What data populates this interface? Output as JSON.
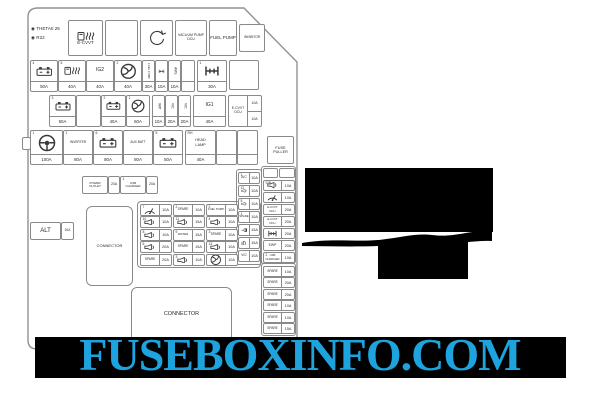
{
  "watermark": {
    "text": "FUSEBOXINFO.COM",
    "color": "#1da4de",
    "band_color": "#000000"
  },
  "corner": {
    "line1": "◉ THETAII 25",
    "line2": "◉ R22"
  },
  "colors": {
    "line": "#8a8a8a",
    "text": "#2b2b2b",
    "redaction": "#000000"
  },
  "boxes": [
    {
      "name": "grid-group",
      "kind": "group",
      "x": 137,
      "y": 201,
      "w": 124,
      "h": 67,
      "r": 4
    },
    {
      "name": "col4-group",
      "kind": "group",
      "x": 236,
      "y": 169,
      "w": 26,
      "h": 96,
      "r": 3
    },
    {
      "name": "strip-group-upper",
      "kind": "group",
      "x": 261,
      "y": 166,
      "w": 35,
      "h": 98,
      "r": 3
    },
    {
      "name": "strip-group-spare",
      "kind": "group",
      "x": 261,
      "y": 263,
      "w": 35,
      "h": 73,
      "r": 3
    },
    {
      "name": "mount-tab",
      "kind": "plain",
      "x": 22,
      "y": 137,
      "w": 9,
      "h": 13
    },
    {
      "name": "module-e-cvvt",
      "kind": "module",
      "x": 68,
      "y": 20,
      "w": 35,
      "h": 36,
      "label": "E-CVVT",
      "icon": "fuel-glow",
      "fs": 4.5
    },
    {
      "name": "module-blank",
      "kind": "module",
      "x": 105,
      "y": 20,
      "w": 33,
      "h": 36
    },
    {
      "name": "module-belt",
      "kind": "module",
      "x": 140,
      "y": 20,
      "w": 33,
      "h": 36,
      "icon": "circle-arrow"
    },
    {
      "name": "module-vacuum-pump-dcu",
      "kind": "module",
      "x": 175,
      "y": 20,
      "w": 32,
      "h": 36,
      "label": "VACUUM PUMP",
      "label2": "DCU",
      "fs": 3.5
    },
    {
      "name": "module-fuel-pump",
      "kind": "module",
      "x": 209,
      "y": 20,
      "w": 28,
      "h": 36,
      "label": "FUEL PUMP",
      "fs": 4.5
    },
    {
      "name": "module-inhibitor",
      "kind": "module",
      "x": 239,
      "y": 24,
      "w": 26,
      "h": 28,
      "label": "INHIBITOR",
      "fs": 3.2
    },
    {
      "name": "fuse-battery-50a",
      "kind": "vfuse",
      "x": 30,
      "y": 60,
      "w": 28,
      "h": 32,
      "icon": "battery",
      "amp": "50A",
      "num": "4"
    },
    {
      "name": "fuse-fuel-heater-40a",
      "kind": "vfuse",
      "x": 58,
      "y": 60,
      "w": 28,
      "h": 32,
      "icon": "fuel-glow",
      "amp": "40A",
      "num": "6"
    },
    {
      "name": "fuse-ig2-40a",
      "kind": "vfuse",
      "x": 86,
      "y": 60,
      "w": 28,
      "h": 32,
      "label": "IG2",
      "amp": "40A",
      "fs": 5
    },
    {
      "name": "fuse-fan-40a",
      "kind": "vfuse",
      "x": 114,
      "y": 60,
      "w": 28,
      "h": 32,
      "icon": "fan",
      "amp": "40A",
      "num": "2"
    },
    {
      "name": "fuse-fuel-pump-30a",
      "kind": "vfuse",
      "x": 142,
      "y": 60,
      "w": 13,
      "h": 32,
      "label": "FUEL PUMP",
      "vert": 1,
      "amp": "30A",
      "fs": 2.8
    },
    {
      "name": "fuse-hub-10a",
      "kind": "vfuse",
      "x": 155,
      "y": 60,
      "w": 13,
      "h": 32,
      "icon": "hub",
      "amp": "10A"
    },
    {
      "name": "fuse-ams-10a",
      "kind": "vfuse",
      "x": 168,
      "y": 60,
      "w": 13,
      "h": 32,
      "label": "AMS",
      "vert": 1,
      "amp": "10A",
      "fs": 3.4
    },
    {
      "name": "fuse-blank-narrow",
      "kind": "vfuse",
      "x": 181,
      "y": 60,
      "w": 14,
      "h": 32,
      "label": "",
      "amp": ""
    },
    {
      "name": "fuse-4wd-30a",
      "kind": "vfuse",
      "x": 197,
      "y": 60,
      "w": 30,
      "h": 32,
      "icon": "hub",
      "amp": "30A",
      "num": "1"
    },
    {
      "name": "box-blank-row1",
      "kind": "plain",
      "x": 229,
      "y": 60,
      "w": 30,
      "h": 30
    },
    {
      "name": "fuse-battery-60a",
      "kind": "vfuse",
      "x": 49,
      "y": 95,
      "w": 27,
      "h": 32,
      "icon": "battery",
      "amp": "60A",
      "num": "3"
    },
    {
      "name": "box-blank-row2",
      "kind": "plain",
      "x": 76,
      "y": 95,
      "w": 25,
      "h": 32
    },
    {
      "name": "fuse-battery-40a",
      "kind": "vfuse",
      "x": 101,
      "y": 95,
      "w": 25,
      "h": 32,
      "icon": "battery",
      "amp": "40A",
      "num": "2"
    },
    {
      "name": "fuse-fan-60a",
      "kind": "vfuse",
      "x": 126,
      "y": 95,
      "w": 24,
      "h": 32,
      "icon": "fan",
      "amp": "60A",
      "num": "1"
    },
    {
      "name": "fuse-wp-10a",
      "kind": "vfuse",
      "x": 152,
      "y": 95,
      "w": 13,
      "h": 32,
      "label": "W/P",
      "vert": 1,
      "amp": "10A",
      "fs": 3.4
    },
    {
      "name": "fuse-vc-20a-1",
      "kind": "vfuse",
      "x": 165,
      "y": 95,
      "w": 13,
      "h": 32,
      "label": "V/C",
      "vert": 1,
      "amp": "20A",
      "fs": 3.4
    },
    {
      "name": "fuse-vc-20a-2",
      "kind": "vfuse",
      "x": 178,
      "y": 95,
      "w": 13,
      "h": 32,
      "label": "V/C",
      "vert": 1,
      "amp": "20A",
      "fs": 3.4
    },
    {
      "name": "fuse-ig1-40a",
      "kind": "vfuse",
      "x": 193,
      "y": 95,
      "w": 33,
      "h": 32,
      "label": "IG1",
      "amp": "40A",
      "fs": 5
    },
    {
      "name": "fuse-ecvvt-dcu-dual",
      "kind": "dual",
      "x": 228,
      "y": 95,
      "w": 34,
      "h": 32,
      "label": "E-CVVT",
      "label2": "DCU",
      "amps": [
        "10A",
        "10A"
      ],
      "fs": 3.4
    },
    {
      "name": "fuse-steering-100a",
      "kind": "vfuse",
      "x": 30,
      "y": 130,
      "w": 33,
      "h": 35,
      "icon": "steering",
      "amp": "100A",
      "num": "1"
    },
    {
      "name": "fuse-inverter-80a",
      "kind": "vfuse",
      "x": 63,
      "y": 130,
      "w": 30,
      "h": 35,
      "label": "INVERTER",
      "amp": "80A",
      "num": "1",
      "fs": 3.2
    },
    {
      "name": "fuse-battery-80a",
      "kind": "vfuse",
      "x": 93,
      "y": 130,
      "w": 30,
      "h": 35,
      "icon": "battery",
      "amp": "80A",
      "num": "6"
    },
    {
      "name": "fuse-aux-batt-80a",
      "kind": "vfuse",
      "x": 123,
      "y": 130,
      "w": 30,
      "h": 35,
      "label": "AUX BATT",
      "amp": "80A",
      "fs": 3.2
    },
    {
      "name": "fuse-battery2-50a",
      "kind": "vfuse",
      "x": 153,
      "y": 130,
      "w": 30,
      "h": 35,
      "icon": "battery",
      "amp": "50A",
      "num": "5"
    },
    {
      "name": "fuse-rh-head-lamp-40a",
      "kind": "vfuse",
      "x": 185,
      "y": 130,
      "w": 31,
      "h": 35,
      "label": "HEAD",
      "label2": "LAMP",
      "amp": "40A",
      "num": "RH",
      "fs": 3.8
    },
    {
      "name": "fuse-blank-row3-1",
      "kind": "vfuse",
      "x": 216,
      "y": 130,
      "w": 21,
      "h": 35,
      "label": "",
      "amp": ""
    },
    {
      "name": "fuse-blank-row3-2",
      "kind": "vfuse",
      "x": 237,
      "y": 130,
      "w": 21,
      "h": 35,
      "label": "",
      "amp": ""
    },
    {
      "name": "fuse-puller",
      "kind": "module",
      "x": 267,
      "y": 136,
      "w": 27,
      "h": 28,
      "label": "FUSE",
      "label2": "PULLER",
      "fs": 3.8
    },
    {
      "name": "module-power-outlet",
      "kind": "module",
      "x": 82,
      "y": 176,
      "w": 26,
      "h": 18,
      "label": "POWER",
      "label2": "OUTLET",
      "fs": 3
    },
    {
      "name": "module-power-outlet-amp",
      "kind": "module",
      "x": 108,
      "y": 176,
      "w": 12,
      "h": 18,
      "label": "20A",
      "fs": 3.4
    },
    {
      "name": "module-usb-charger",
      "kind": "module",
      "x": 120,
      "y": 176,
      "w": 26,
      "h": 18,
      "label": "USB",
      "label2": "CHARGER",
      "fs": 3,
      "num": "1"
    },
    {
      "name": "module-usb-charger-amp",
      "kind": "module",
      "x": 146,
      "y": 176,
      "w": 12,
      "h": 18,
      "label": "20A",
      "fs": 3.4
    },
    {
      "name": "module-alt",
      "kind": "module",
      "x": 30,
      "y": 222,
      "w": 31,
      "h": 18,
      "label": "ALT",
      "fs": 6
    },
    {
      "name": "module-alt-amp",
      "kind": "module",
      "x": 61,
      "y": 222,
      "w": 13,
      "h": 18,
      "label": "20A",
      "fs": 3.2
    },
    {
      "name": "connector-small",
      "kind": "module",
      "x": 86,
      "y": 206,
      "w": 47,
      "h": 80,
      "label": "CONNECTOR",
      "fs": 4,
      "r": 6
    },
    {
      "name": "connector-large",
      "kind": "module",
      "x": 131,
      "y": 287,
      "w": 101,
      "h": 56,
      "label": "CONNECTOR",
      "fs": 5.5,
      "r": 6
    },
    {
      "name": "grid-c1-wiper",
      "kind": "hfuse",
      "x": 140,
      "y": 204,
      "w": 32,
      "h": 12,
      "icon": "wiper",
      "amp": "10A",
      "num": "7"
    },
    {
      "name": "grid-c1-horn1",
      "kind": "hfuse",
      "x": 140,
      "y": 216,
      "w": 32,
      "h": 12,
      "icon": "horn",
      "amp": "10A",
      "num": "10"
    },
    {
      "name": "grid-c1-horn2",
      "kind": "hfuse",
      "x": 140,
      "y": 229,
      "w": 32,
      "h": 12,
      "icon": "horn",
      "amp": "10A",
      "num": "8"
    },
    {
      "name": "grid-c1-horn3",
      "kind": "hfuse",
      "x": 140,
      "y": 241,
      "w": 32,
      "h": 12,
      "icon": "horn",
      "amp": "20A",
      "num": "6"
    },
    {
      "name": "grid-c1-spare",
      "kind": "hfuse",
      "x": 140,
      "y": 254,
      "w": 32,
      "h": 12,
      "label": "SPARE",
      "amp": "20A",
      "fs": 3.2
    },
    {
      "name": "grid-c2-spare1",
      "kind": "hfuse",
      "x": 173,
      "y": 204,
      "w": 32,
      "h": 12,
      "label": "SPARE",
      "amp": "10A",
      "fs": 3.2,
      "num": "2"
    },
    {
      "name": "grid-c2-horn1",
      "kind": "hfuse",
      "x": 173,
      "y": 216,
      "w": 32,
      "h": 12,
      "icon": "horn",
      "amp": "15A",
      "num": "11"
    },
    {
      "name": "grid-c2-water",
      "kind": "hfuse",
      "x": 173,
      "y": 229,
      "w": 32,
      "h": 12,
      "label": "WATER",
      "amp": "15A",
      "fs": 3,
      "num": "9"
    },
    {
      "name": "grid-c2-spare2",
      "kind": "hfuse",
      "x": 173,
      "y": 241,
      "w": 32,
      "h": 12,
      "label": "SPARE",
      "amp": "15A",
      "fs": 3.2
    },
    {
      "name": "grid-c2-horn2",
      "kind": "hfuse",
      "x": 173,
      "y": 254,
      "w": 32,
      "h": 12,
      "icon": "horn",
      "amp": "10A",
      "num": "3"
    },
    {
      "name": "grid-c3-fuel-pump",
      "kind": "hfuse",
      "x": 206,
      "y": 204,
      "w": 32,
      "h": 12,
      "label": "FUEL PUMP",
      "amp": "10A",
      "fs": 2.8,
      "num": "2"
    },
    {
      "name": "grid-c3-horn1",
      "kind": "hfuse",
      "x": 206,
      "y": 216,
      "w": 32,
      "h": 12,
      "icon": "horn",
      "amp": "10A",
      "num": "4"
    },
    {
      "name": "grid-c3-spare",
      "kind": "hfuse",
      "x": 206,
      "y": 229,
      "w": 32,
      "h": 12,
      "label": "SPARE",
      "amp": "10A",
      "fs": 3.2,
      "num": "3"
    },
    {
      "name": "grid-c3-horn2",
      "kind": "hfuse",
      "x": 206,
      "y": 241,
      "w": 32,
      "h": 12,
      "icon": "horn",
      "amp": "10A",
      "num": "13"
    },
    {
      "name": "grid-c3-fan",
      "kind": "hfuse",
      "x": 206,
      "y": 254,
      "w": 32,
      "h": 12,
      "icon": "fan",
      "amp": "10A"
    },
    {
      "name": "col4-ac",
      "kind": "hfuse",
      "x": 238,
      "y": 172,
      "w": 22,
      "h": 12,
      "aw": 9,
      "label": "A/C",
      "amp": "10A",
      "fs": 3.4,
      "num": "1"
    },
    {
      "name": "col4-horn1",
      "kind": "hfuse",
      "x": 238,
      "y": 185,
      "w": 22,
      "h": 12,
      "aw": 9,
      "icon": "horn",
      "amp": "10A",
      "num": "12"
    },
    {
      "name": "col4-horn2",
      "kind": "hfuse",
      "x": 238,
      "y": 198,
      "w": 22,
      "h": 12,
      "aw": 9,
      "icon": "horn",
      "amp": "10A",
      "num": "5"
    },
    {
      "name": "col4-spare",
      "kind": "hfuse",
      "x": 238,
      "y": 211,
      "w": 22,
      "h": 12,
      "aw": 9,
      "label": "SPARE",
      "amp": "10A",
      "fs": 2.8,
      "num": "1"
    },
    {
      "name": "col4-lamp",
      "kind": "hfuse",
      "x": 238,
      "y": 224,
      "w": 22,
      "h": 12,
      "aw": 9,
      "icon": "lamp",
      "amp": "15A"
    },
    {
      "name": "col4-headlight",
      "kind": "hfuse",
      "x": 238,
      "y": 237,
      "w": 22,
      "h": 12,
      "aw": 9,
      "icon": "headlight",
      "amp": "15A"
    },
    {
      "name": "col4-vc",
      "kind": "hfuse",
      "x": 238,
      "y": 250,
      "w": 22,
      "h": 12,
      "aw": 9,
      "label": "V/C",
      "amp": "10A",
      "fs": 3.4
    },
    {
      "name": "strip-top-blank1",
      "kind": "plain",
      "x": 263,
      "y": 168,
      "w": 15,
      "h": 10
    },
    {
      "name": "strip-top-blank2",
      "kind": "plain",
      "x": 279,
      "y": 168,
      "w": 16,
      "h": 10
    },
    {
      "name": "strip-horn",
      "kind": "hfuse",
      "x": 263,
      "y": 180,
      "w": 32,
      "h": 11,
      "aw": 12,
      "icon": "horn",
      "amp": "10A",
      "num": "S/B"
    },
    {
      "name": "strip-wiper",
      "kind": "hfuse",
      "x": 263,
      "y": 192,
      "w": 32,
      "h": 11,
      "aw": 12,
      "icon": "wiper",
      "amp": "10A"
    },
    {
      "name": "strip-ecvvt1",
      "kind": "hfuse",
      "x": 263,
      "y": 204,
      "w": 32,
      "h": 11,
      "aw": 12,
      "label": "E-CVVT",
      "label2": "DCU",
      "amp": "20A",
      "fs": 2.8
    },
    {
      "name": "strip-ecvvt2",
      "kind": "hfuse",
      "x": 263,
      "y": 216,
      "w": 32,
      "h": 11,
      "aw": 12,
      "label": "E-CVVT",
      "label2": "DCU",
      "amp": "20A",
      "fs": 2.8
    },
    {
      "name": "strip-hub",
      "kind": "hfuse",
      "x": 263,
      "y": 228,
      "w": 32,
      "h": 11,
      "aw": 12,
      "icon": "hub",
      "amp": "20A"
    },
    {
      "name": "strip-ewp",
      "kind": "hfuse",
      "x": 263,
      "y": 240,
      "w": 32,
      "h": 11,
      "aw": 12,
      "label": "EWP",
      "amp": "20A",
      "fs": 3.4
    },
    {
      "name": "strip-usb-charger",
      "kind": "hfuse",
      "x": 263,
      "y": 252,
      "w": 32,
      "h": 11,
      "aw": 12,
      "label": "USB",
      "label2": "CHARGER",
      "amp": "10A",
      "fs": 2.8,
      "num": "2"
    },
    {
      "name": "strip-spare1",
      "kind": "hfuse",
      "x": 263,
      "y": 266,
      "w": 32,
      "h": 11,
      "aw": 12,
      "label": "SPARE",
      "amp": "10A",
      "fs": 3.2
    },
    {
      "name": "strip-spare2",
      "kind": "hfuse",
      "x": 263,
      "y": 277,
      "w": 32,
      "h": 11,
      "aw": 12,
      "label": "SPARE",
      "amp": "20A",
      "fs": 3.2
    },
    {
      "name": "strip-spare3",
      "kind": "hfuse",
      "x": 263,
      "y": 289,
      "w": 32,
      "h": 11,
      "aw": 12,
      "label": "SPARE",
      "amp": "20A",
      "fs": 3.2
    },
    {
      "name": "strip-spare4",
      "kind": "hfuse",
      "x": 263,
      "y": 300,
      "w": 32,
      "h": 11,
      "aw": 12,
      "label": "SPARE",
      "amp": "10A",
      "fs": 3.2
    },
    {
      "name": "strip-spare5",
      "kind": "hfuse",
      "x": 263,
      "y": 312,
      "w": 32,
      "h": 11,
      "aw": 12,
      "label": "SPARE",
      "amp": "10A",
      "fs": 3.2
    },
    {
      "name": "strip-spare6",
      "kind": "hfuse",
      "x": 263,
      "y": 323,
      "w": 32,
      "h": 11,
      "aw": 12,
      "label": "SPARE",
      "amp": "15A",
      "fs": 3.2
    }
  ]
}
